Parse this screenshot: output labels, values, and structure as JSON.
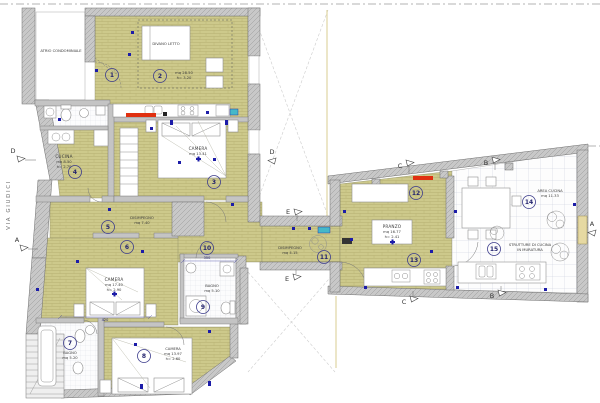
{
  "plan": {
    "street_label": "VIA GIUDICI",
    "sections": {
      "a": "A",
      "b": "B",
      "c": "C",
      "d": "D",
      "e": "E"
    },
    "rooms": [
      {
        "number": "1"
      },
      {
        "number": "2"
      },
      {
        "number": "3"
      },
      {
        "number": "4"
      },
      {
        "number": "5"
      },
      {
        "number": "6"
      },
      {
        "number": "7"
      },
      {
        "number": "8"
      },
      {
        "number": "9"
      },
      {
        "number": "10"
      },
      {
        "number": "11"
      },
      {
        "number": "12"
      },
      {
        "number": "13"
      },
      {
        "number": "14"
      },
      {
        "number": "15"
      }
    ],
    "labels": {
      "atrio": "ATRIO CONDOMINIALE",
      "divano_letto": "DIVANO LETTO",
      "soggiorno_area": "mq 28.50",
      "soggiorno_height": "h= 3.20",
      "camera3_name": "CAMERA",
      "camera3_area": "mq 13.41",
      "cucina_name": "CUCINA",
      "cucina_area": "mq 8.50",
      "cucina_height": "h= 2.70",
      "disimpegno5_name": "DISIMPEGNO",
      "disimpegno5_area": "mq 7.40",
      "camera6_name": "CAMERA",
      "camera6_area": "mq 17.40",
      "camera6_height": "h= 2.90",
      "bagno7_name": "BAGNO",
      "bagno7_area": "mq 5.20",
      "camera8_name": "CAMERA",
      "camera8_area": "mq 13.97",
      "camera8_height": "h= 2.60",
      "bagno9_name": "BAGNO",
      "bagno9_area": "mq 5.10",
      "disimpegno11_name": "DISIMPEGNO",
      "disimpegno11_area": "mq 4.15",
      "pranzo_name": "PRANZO",
      "pranzo_area": "mq 16.77",
      "pranzo_height": "h= 2.41",
      "area_cucina_name": "AREA CUCINA",
      "area_cucina_area": "mq 11.33",
      "strutture_line1": "STRUTTURE DI CUCINA",
      "strutture_line2": "IN MURATURA"
    },
    "dimensions": {
      "camera6_width": "420",
      "bagno9_width": "350"
    },
    "colors": {
      "floor_parquet": "#cdc98b",
      "floor_parquet_line": "#b2ad6d",
      "wall_fill": "#c8c8c8",
      "wall_hatch": "#9a9a9a",
      "tile_line": "#c6ccd9",
      "bath_tile_line": "#d9dde5",
      "marker_blue": "#1c1ca8",
      "marker_red": "#e03010",
      "marker_cyan": "#45b8c8",
      "plaster_yellow": "#ddd29a"
    }
  }
}
